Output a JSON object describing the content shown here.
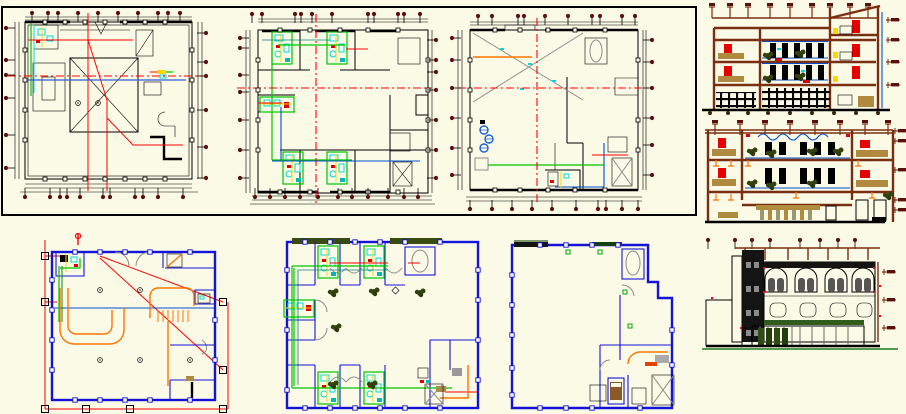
{
  "sheet": {
    "title": "architectural-cad-sheet",
    "background": "#FBFAE7"
  },
  "palette": {
    "ink": "#000000",
    "wall_blue": "#1414D8",
    "line_blue": "#0050D0",
    "red": "#FF0000",
    "marker_maroon": "#5C1010",
    "section_brown": "#7A2E10",
    "pipe_green": "#00C400",
    "plant_green": "#33430F",
    "cyan": "#00D9D9",
    "orange": "#FF7400",
    "yellow": "#FFD700",
    "tan": "#B08A3E",
    "gray": "#8C8C8C",
    "glass_gray": "#555555",
    "ground_green": "#1E7A1E"
  },
  "panels": [
    {
      "id": "floor-plan-1",
      "label": "floor plan 1"
    },
    {
      "id": "floor-plan-2",
      "label": "floor plan 2"
    },
    {
      "id": "floor-plan-3",
      "label": "floor plan 3"
    },
    {
      "id": "section-1",
      "label": "building section 1"
    },
    {
      "id": "section-2",
      "label": "building section 2"
    },
    {
      "id": "front-elevation",
      "label": "front elevation"
    },
    {
      "id": "plan-4",
      "label": "installation plan"
    },
    {
      "id": "plan-5",
      "label": "typical floor plan"
    },
    {
      "id": "plan-6",
      "label": "open floor plan"
    }
  ]
}
